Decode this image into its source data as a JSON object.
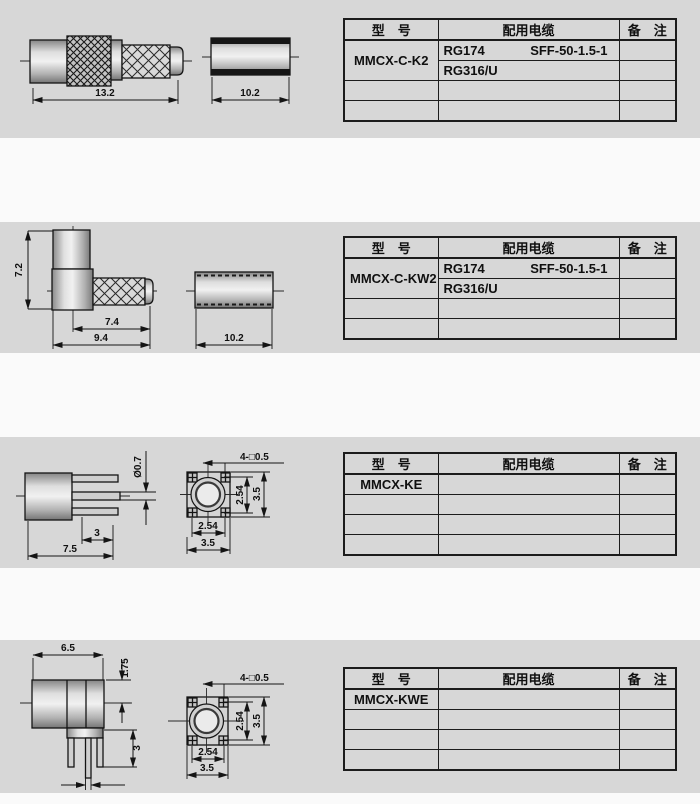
{
  "colors": {
    "panel_bg": "#d7d7d7",
    "gap_bg": "#fafafa",
    "line": "#1c1c1c"
  },
  "table_header": {
    "model": "型　号",
    "cable": "配用电缆",
    "remark": "备　注"
  },
  "sections": [
    {
      "model": "MMCX-C-K2",
      "cables": [
        "RG174",
        "SFF-50-1.5-1",
        "RG316/U"
      ],
      "dims": {
        "len": "13.2",
        "ferrule": "10.2"
      }
    },
    {
      "model": "MMCX-C-KW2",
      "cables": [
        "RG174",
        "SFF-50-1.5-1",
        "RG316/U"
      ],
      "dims": {
        "height": "7.2",
        "horiz": "7.4",
        "total": "9.4",
        "ferrule": "10.2"
      }
    },
    {
      "model": "MMCX-KE",
      "cables": [],
      "dims": {
        "pin_dia": "Ø0.7",
        "pin_len": "3",
        "len": "7.5",
        "pins": "4-□0.5",
        "pitch_r": "2.54",
        "size_r": "3.5",
        "pitch_b": "2.54",
        "size_b": "3.5"
      }
    },
    {
      "model": "MMCX-KWE",
      "cables": [],
      "dims": {
        "len": "6.5",
        "offset": "1.75",
        "pin_len": "3",
        "pins": "4-□0.5",
        "pitch_r": "2.54",
        "size_r": "3.5",
        "pitch_b": "2.54",
        "size_b": "3.5"
      }
    }
  ]
}
